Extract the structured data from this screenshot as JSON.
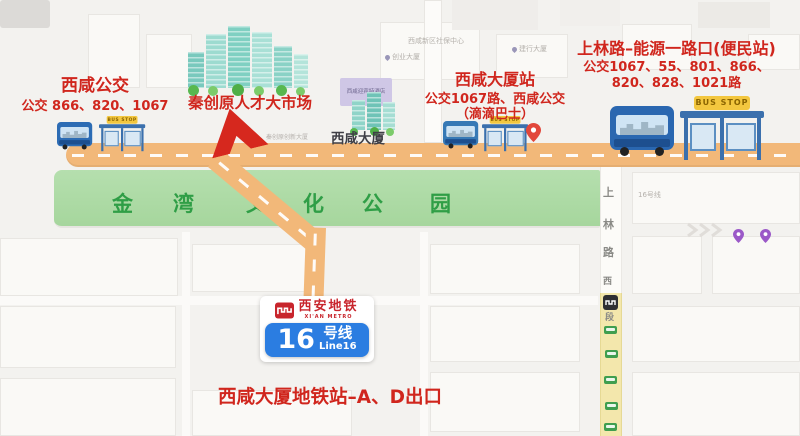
{
  "stops": {
    "left": {
      "title": "西咸公交",
      "lines": "公交 866、820、1067"
    },
    "center": {
      "title": "西咸大厦站",
      "lines": "公交1067路、西咸公交",
      "note": "（滴滴巴士）"
    },
    "right": {
      "title": "上林路–能源一路口(便民站)",
      "lines1": "公交1067、55、801、866、",
      "lines2": "820、828、1021路"
    }
  },
  "market": {
    "label": "秦创原人才大市场",
    "sub_label": "秦创原创新大厦"
  },
  "tower": {
    "label": "西咸大厦",
    "hotel_label": "西咸迎宾特酒店"
  },
  "park": {
    "chars": [
      "金",
      "湾",
      "文",
      "化",
      "公",
      "园"
    ]
  },
  "road": {
    "chars": [
      "上",
      "林",
      "路",
      "西",
      "段"
    ],
    "line_hint": "16号线"
  },
  "poi": {
    "social_center": "西咸新区社保中心",
    "pin1": "创业大厦",
    "pin2": "建行大厦"
  },
  "bus_stop_sign": "BUS STOP",
  "metro": {
    "brand_cn": "西安地铁",
    "brand_en": "XI'AN METRO",
    "line_number": "16",
    "line_suffix": "号线",
    "line_en": "Line16"
  },
  "bottom_note": "西咸大厦地铁站–A、D出口",
  "colors": {
    "accent_red": "#d0261d",
    "road_orange": "#f2b879",
    "park_green": "#abd8a2",
    "park_text_green": "#2f9e46",
    "metro_blue": "#2b7de1",
    "logo_red": "#c8252c",
    "bus_blue": "#2c6cb4",
    "sign_yellow": "#f3c73f"
  }
}
